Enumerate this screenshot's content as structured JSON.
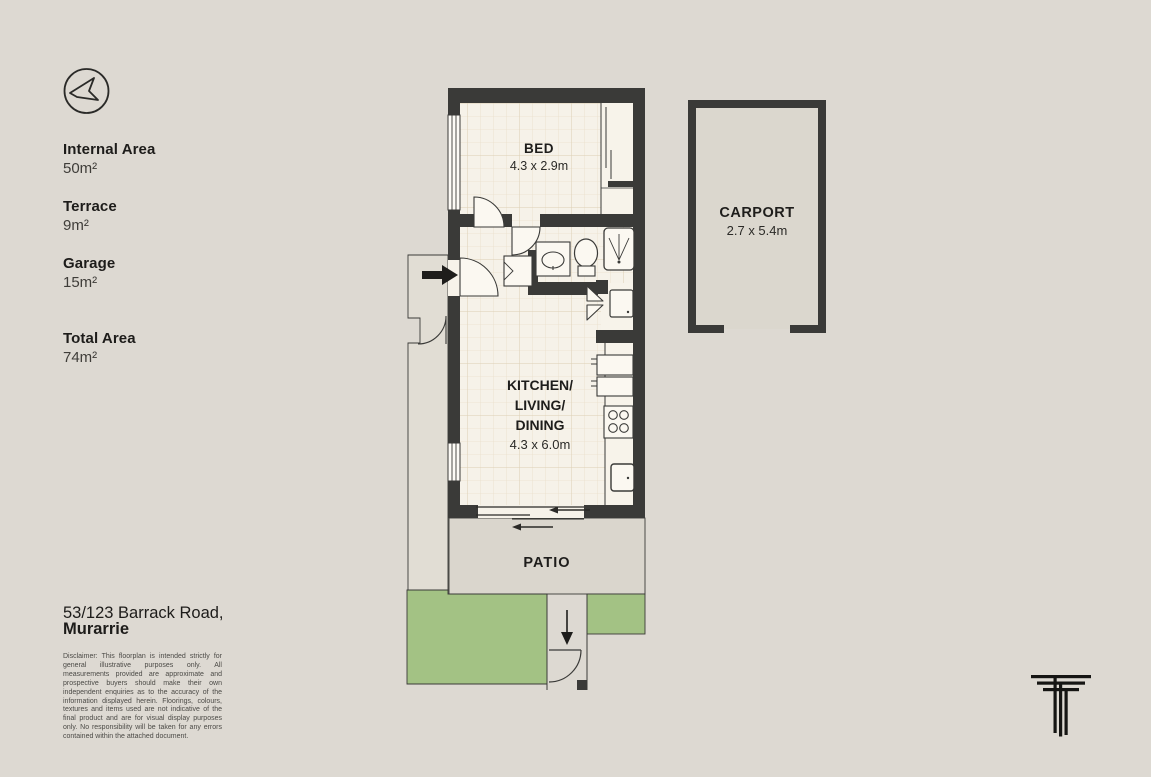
{
  "page": {
    "title": "Floorplan"
  },
  "colors": {
    "background": "#DDD9D2",
    "wall": "#3A3A38",
    "floor": "#F6F2E9",
    "grid_line": "#EADFCA",
    "patio": "#DAD6CD",
    "porch": "#E1DDD4",
    "lawn": "#A3C284",
    "carport_floor": "#DBD7CE",
    "text_dark": "#1D1C1A"
  },
  "icons": {
    "compass": "compass-arrow-icon",
    "entry": "entry-arrow-icon",
    "path": "down-arrow-icon",
    "logo": "triple-t-logo"
  },
  "areas": [
    {
      "label": "Internal Area",
      "value": "50m²"
    },
    {
      "label": "Terrace",
      "value": "9m²"
    },
    {
      "label": "Garage",
      "value": "15m²"
    },
    {
      "label": "Total Area",
      "value": "74m²"
    }
  ],
  "address": {
    "line1": "53/123 Barrack Road,",
    "line2": "Murarrie"
  },
  "disclaimer": "Disclaimer: This floorplan is intended strictly for general illustrative purposes only. All measurements provided are approximate and prospective buyers should make their own independent enquiries as to the accuracy of the information displayed herein. Floorings, colours, textures and items used are not indicative of the final product and are for visual display purposes only. No responsibility will be taken for any errors contained within the attached document.",
  "rooms": {
    "bed": {
      "name": "BED",
      "dims": "4.3 x 2.9m"
    },
    "kitchen": {
      "line1": "KITCHEN/",
      "line2": "LIVING/",
      "line3": "DINING",
      "dims": "4.3 x 6.0m"
    },
    "patio": {
      "name": "PATIO"
    },
    "carport": {
      "name": "CARPORT",
      "dims": "2.7 x 5.4m"
    }
  }
}
